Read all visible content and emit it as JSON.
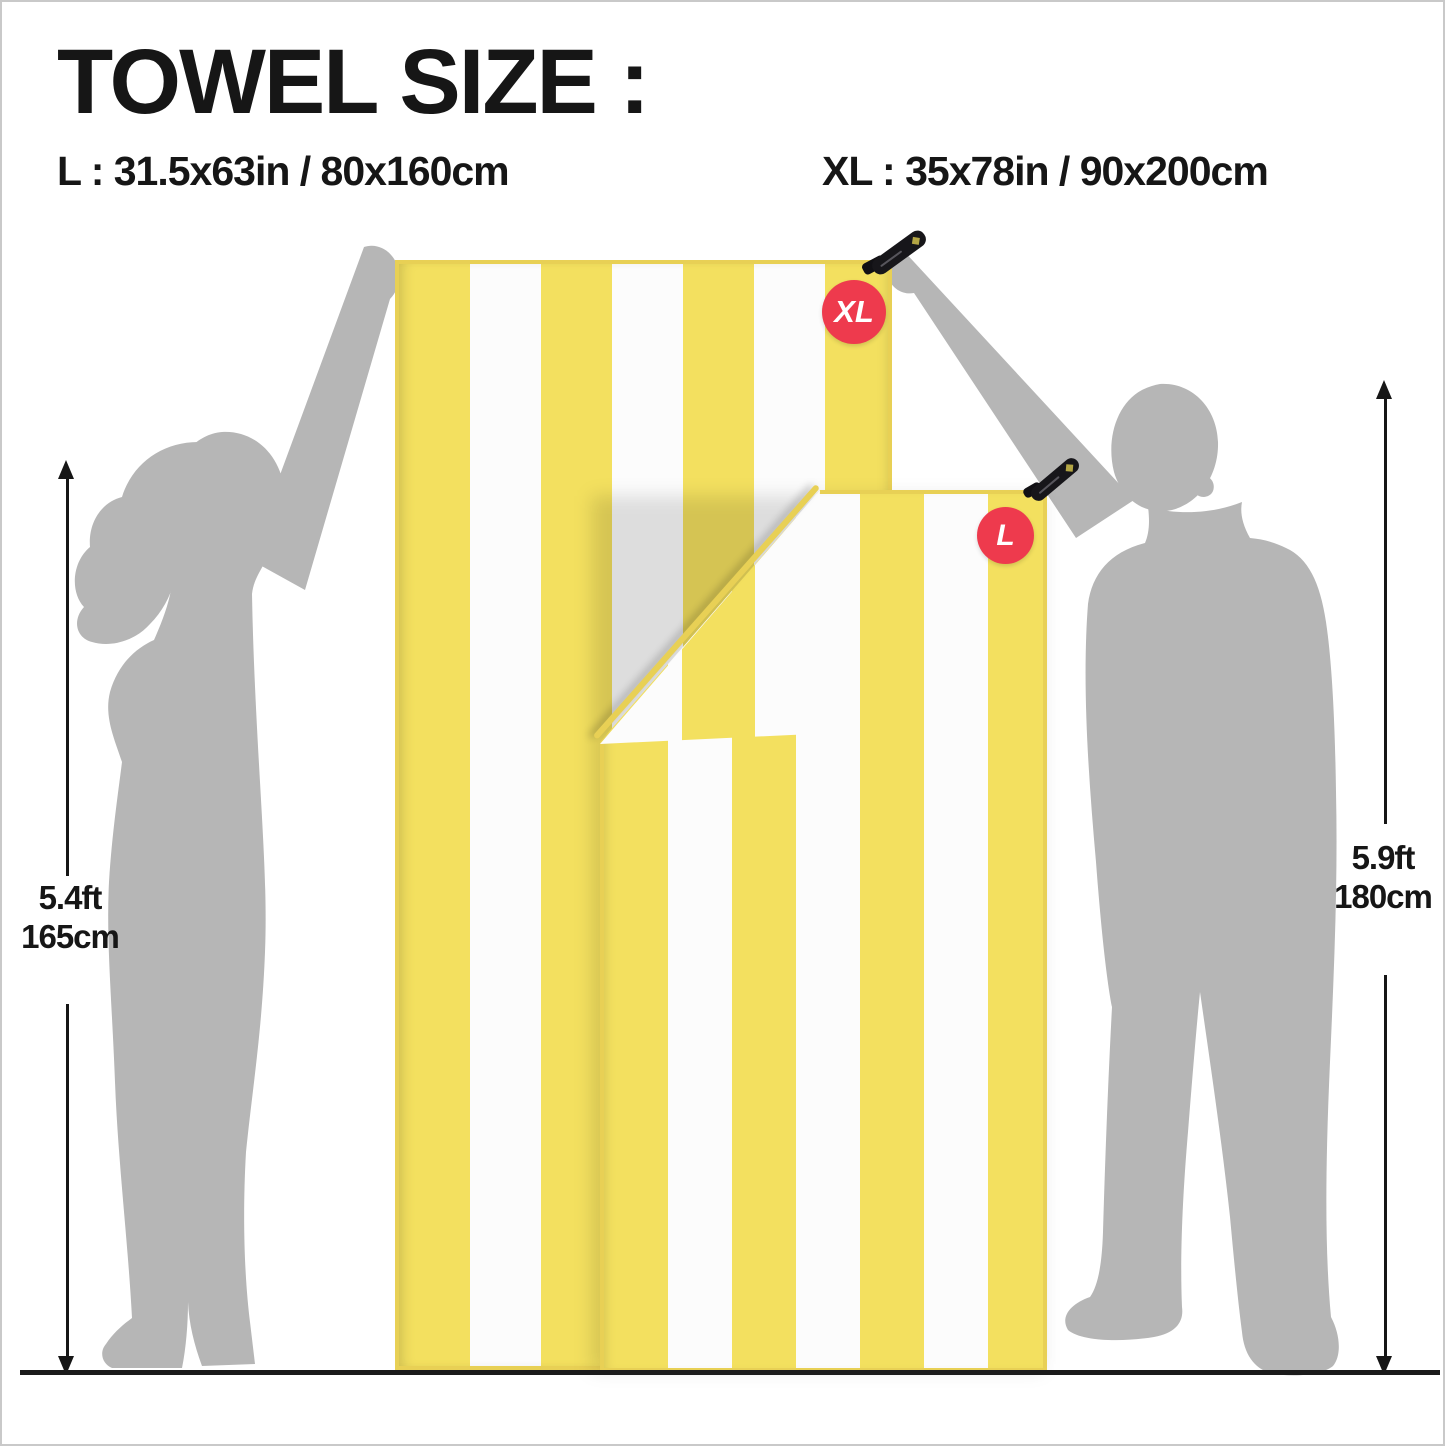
{
  "title": "TOWEL SIZE :",
  "size_lines": {
    "l": "L : 31.5x63in / 80x160cm",
    "xl": "XL : 35x78in / 90x200cm"
  },
  "towels": {
    "xl": {
      "badge": "XL"
    },
    "l": {
      "badge": "L"
    }
  },
  "measurements": {
    "left": {
      "feet": "5.4ft",
      "cm": "165cm"
    },
    "right": {
      "feet": "5.9ft",
      "cm": "180cm"
    }
  },
  "icons": {
    "hang_tag": "black-strap"
  },
  "colors": {
    "towel_yellow": "#F3E05F",
    "towel_white": "#FCFCFC",
    "towel_hem": "#E8D055",
    "badge_red": "#EE3A4D",
    "silhouette_gray": "#B6B6B6",
    "ink": "#161616",
    "ground": "#1B1B1B"
  }
}
